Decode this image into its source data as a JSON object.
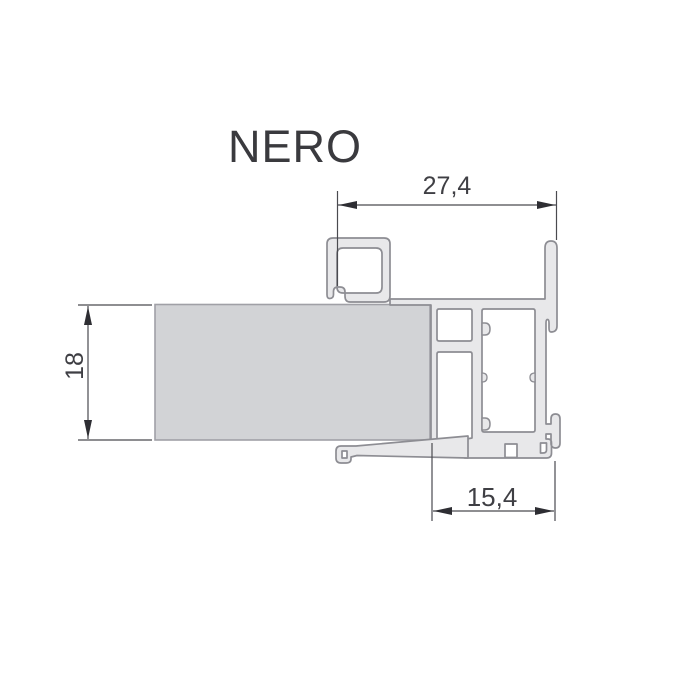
{
  "title": "NERO",
  "dimensions": {
    "top_width": "27,4",
    "left_height": "18",
    "bottom_width": "15,4"
  },
  "colors": {
    "background": "#ffffff",
    "profile_fill": "#e8e8ea",
    "profile_stroke": "#8d8d93",
    "glass_fill": "#d2d3d6",
    "glass_stroke": "#a0a0a6",
    "dimension_line": "#4a4a4f",
    "arrow_fill": "#2e2e33",
    "text": "#3a3a3e"
  }
}
